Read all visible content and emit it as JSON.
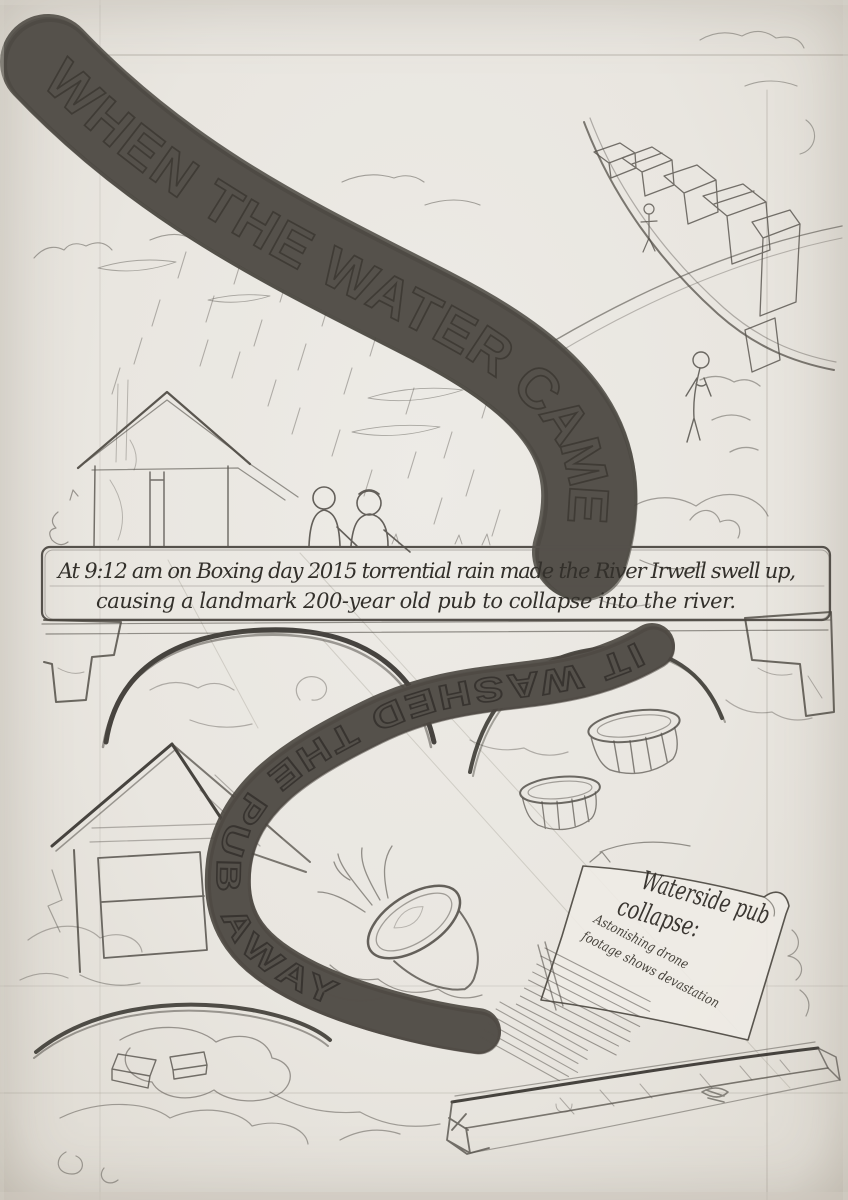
{
  "artwork": {
    "title": "WHEN THE WATER CAME",
    "caption": {
      "line1": "At 9:12 am on Boxing day 2015 torrential rain made the River Irwell swell up,",
      "line2": "causing a landmark 200-year old pub to collapse into the river."
    },
    "ribbon_phrase": "IT WASHED THE PUB AWAY",
    "newspaper": {
      "headline_line1": "Waterside pub",
      "headline_line2": "collapse:",
      "subhead_line1": "Astonishing drone",
      "subhead_line2": "footage shows devastation"
    },
    "colors": {
      "paper": "#e9e6e0",
      "pencil": "#55514b",
      "pencil_dark": "#34312c",
      "guide_line": "#938d82"
    }
  }
}
